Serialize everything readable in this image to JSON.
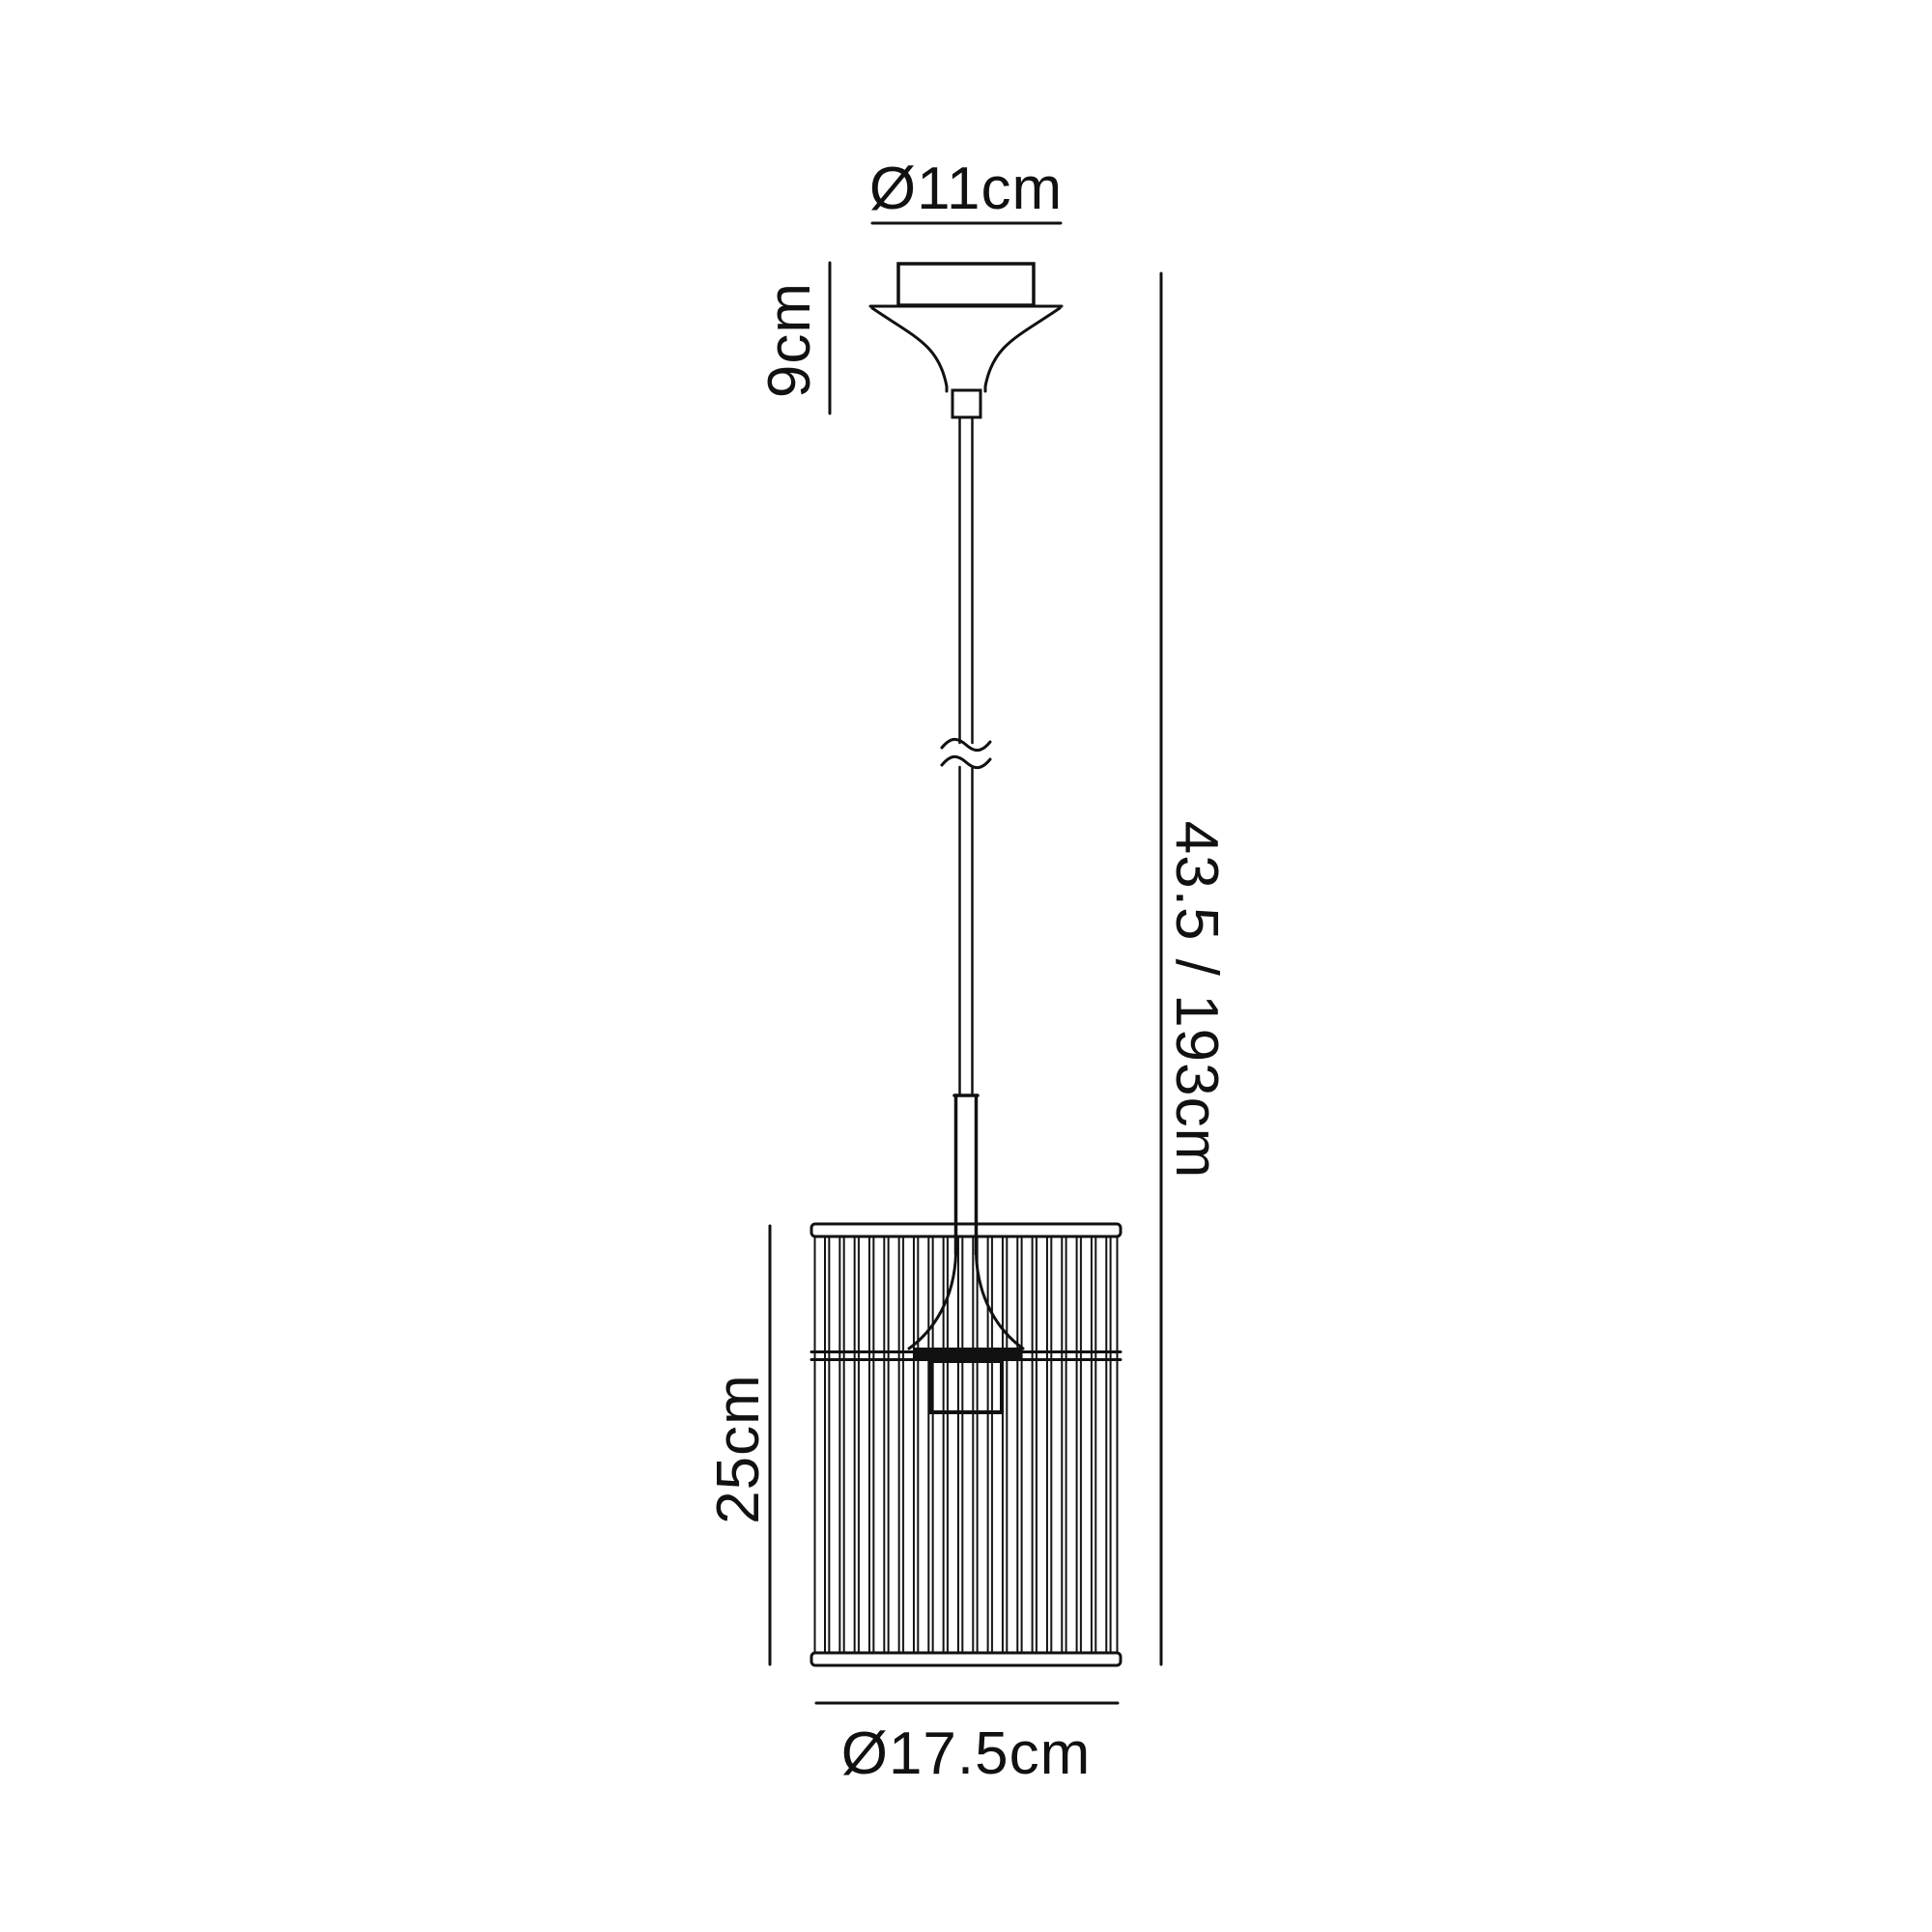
{
  "page": {
    "background_color": "#ffffff",
    "line_color": "#111111",
    "text_color": "#111111"
  },
  "diagram": {
    "type": "pendant-light-dimension-drawing",
    "labels": {
      "canopy_diameter": "Ø11cm",
      "canopy_height": "9cm",
      "overall_height": "43.5 / 193cm",
      "shade_height": "25cm",
      "shade_diameter": "Ø17.5cm"
    }
  }
}
